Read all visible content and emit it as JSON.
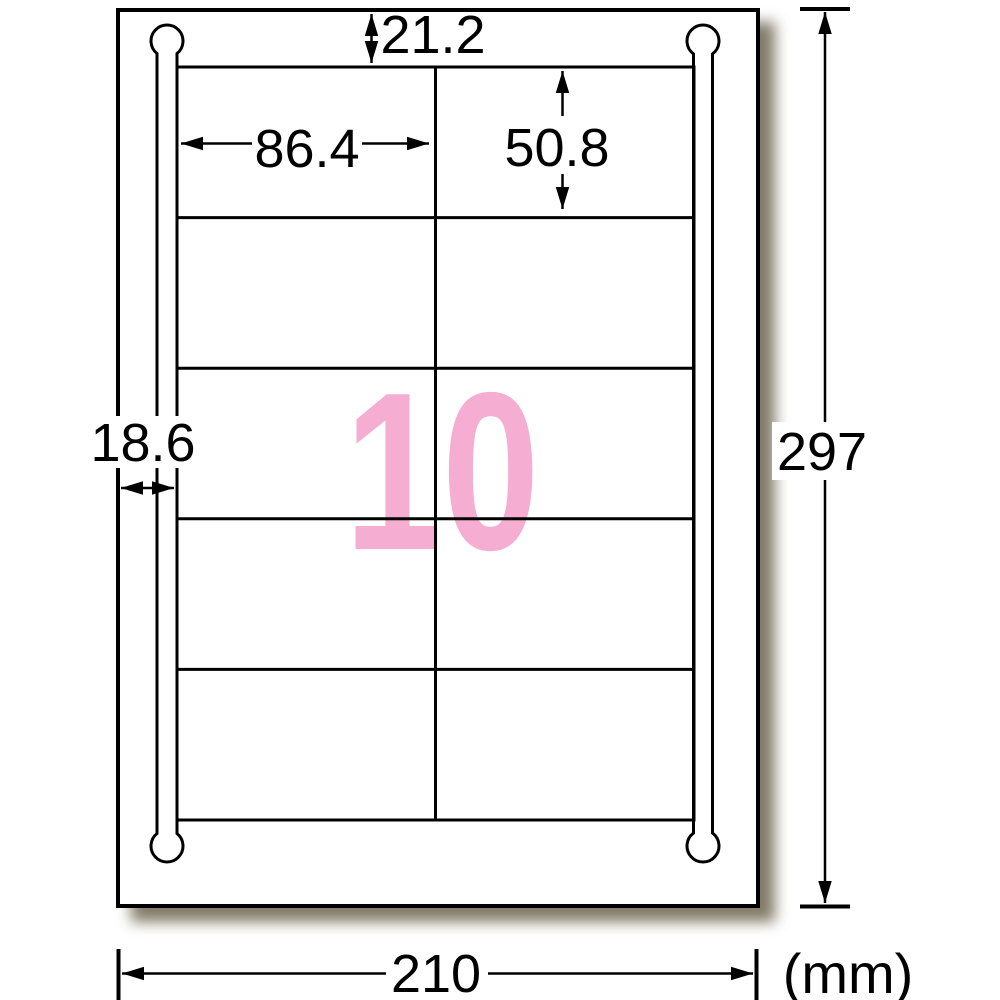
{
  "diagram_title": "label-sheet-dimension-diagram",
  "sheet": {
    "width_mm": "210",
    "height_mm": "297",
    "unit": "(mm)"
  },
  "label": {
    "count": "10",
    "width_mm": "86.4",
    "height_mm": "50.8",
    "top_margin_mm": "21.2",
    "side_margin_mm": "18.6"
  },
  "grid": {
    "columns": 2,
    "rows": 5
  },
  "colors": {
    "count_pink": "#f5add1",
    "line": "#000000",
    "paper": "#ffffff"
  }
}
